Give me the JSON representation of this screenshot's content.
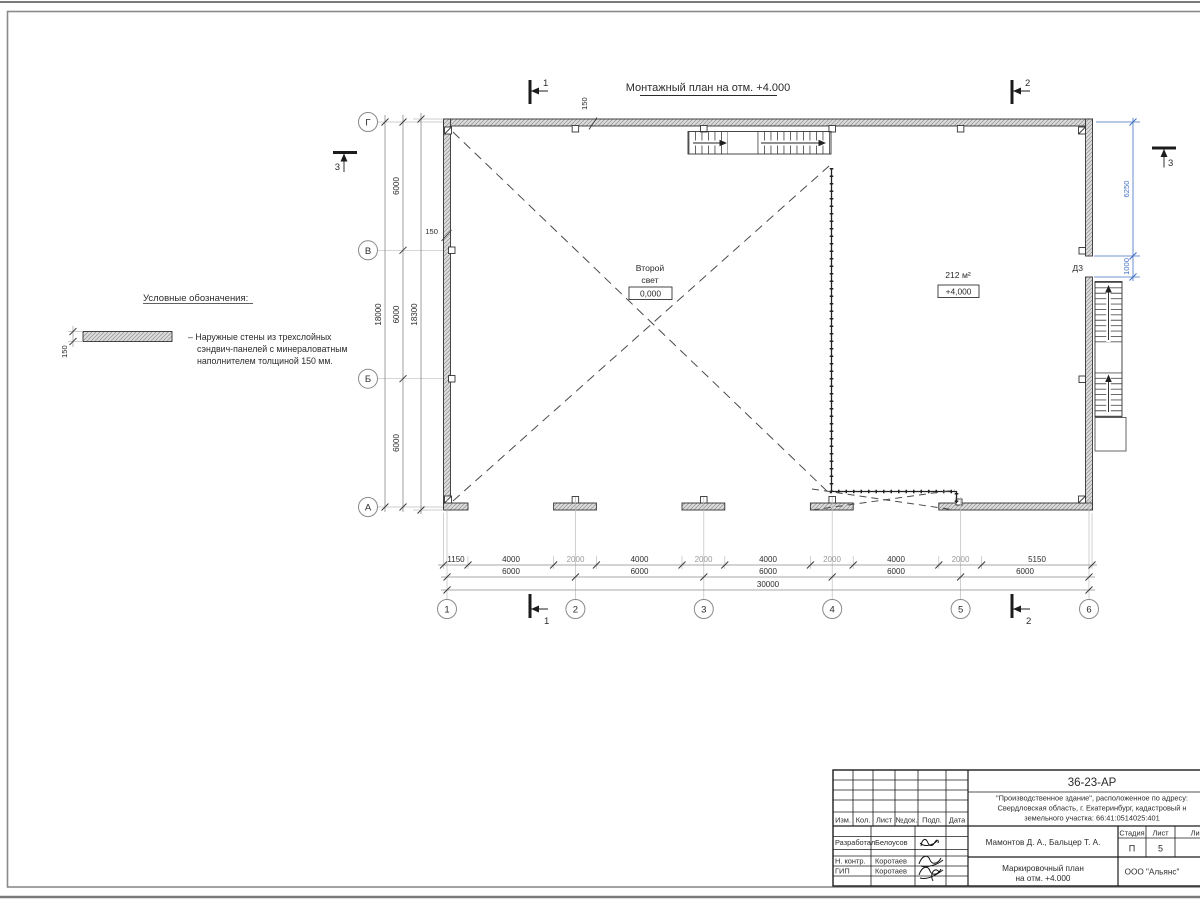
{
  "sheet": {
    "title": "Монтажный план на отм. +4.000"
  },
  "legend": {
    "heading": "Условные обозначения:",
    "symbol_dim": "150",
    "item_line1": "– Наружные стены из трехслойных",
    "item_line2": "сэндвич-панелей с минераловатным",
    "item_line3": "наполнителем толщиной 150 мм."
  },
  "plan": {
    "room_left_line1": "Второй",
    "room_left_line2": "свет",
    "room_left_level": "0,000",
    "room_right_area": "212 м²",
    "room_right_level": "+4,000",
    "door_label": "Д3",
    "wall_thk_top": "150",
    "wall_thk_left": "150"
  },
  "grid": {
    "rows": [
      "Г",
      "В",
      "Б",
      "А"
    ],
    "cols": [
      "1",
      "2",
      "3",
      "4",
      "5",
      "6"
    ]
  },
  "dims": {
    "chain1": [
      "1150",
      "4000",
      "2000",
      "4000",
      "2000",
      "4000",
      "2000",
      "4000",
      "2000",
      "5150"
    ],
    "chain2": [
      "6000",
      "6000",
      "6000",
      "6000",
      "6000"
    ],
    "total": "30000",
    "left_chain": [
      "6000",
      "6000",
      "6000"
    ],
    "left_axes_total": "18000",
    "left_outer_total": "18300",
    "right_upper": "6250",
    "right_lower": "1000"
  },
  "sections": {
    "s1": "1",
    "s2": "2",
    "s3": "3"
  },
  "titleblock": {
    "code": "36-23-АР",
    "desc1": "\"Производственное здание\", расположенное по адресу:",
    "desc2": "Свердловская область, г. Екатеринбург, кадастровый н",
    "desc3": "земельного участка: 66:41:0514025:401",
    "h_izm": "Изм.",
    "h_kol": "Кол.",
    "h_list": "Лист",
    "h_ndok": "№док.",
    "h_podp": "Подп.",
    "h_data": "Дата",
    "row1_role": "Разработал",
    "row1_name": "Белоусов",
    "row2_role": "Н. контр.",
    "row2_name": "Коротаев",
    "row3_role": "ГИП",
    "row3_name": "Коротаев",
    "authors": "Мамонтов Д. А., Бальцер Т. А.",
    "stage_label": "Стадия",
    "sheet_label": "Лист",
    "sheets_label": "Лис",
    "stage_value": "П",
    "sheet_value": "5",
    "doc_title1": "Маркировочный план",
    "doc_title2": "на отм. +4.000",
    "company": "ООО \"Альянс\""
  },
  "colors": {
    "dim_accent_blue": "#4472c4",
    "line_dark": "#333333",
    "line_light": "#bbbbbb",
    "wall_fill": "#dcdcdc"
  }
}
